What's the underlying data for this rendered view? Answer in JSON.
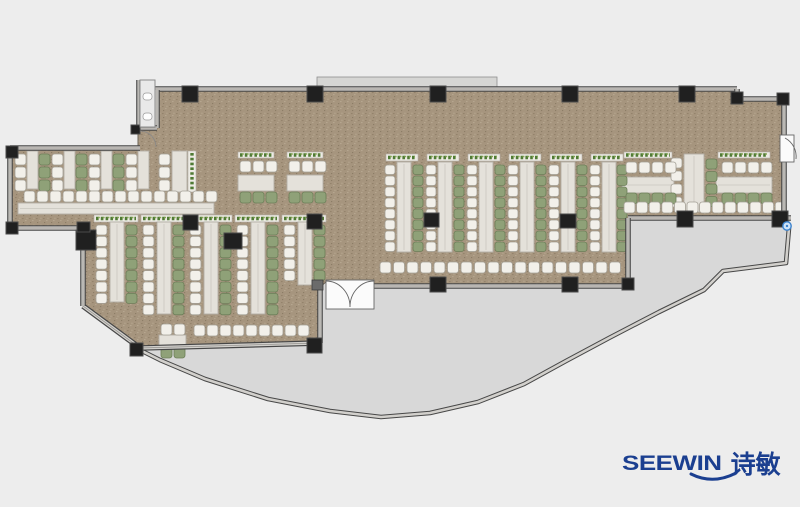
{
  "canvas": {
    "width": 800,
    "height": 507,
    "background": "#ededed"
  },
  "colors": {
    "floor_base": "#a6957e",
    "floor_speck_dark": "#94836c",
    "floor_speck_darker": "#8c7d66",
    "floor_speck_light": "#b5a68f",
    "terrace": "#d8d8d8",
    "terrace_edge": "#9a9a9a",
    "wall_dark": "#474747",
    "wall_fill": "#d2d0cc",
    "wall_center": "#8f8d89",
    "column": "#202020",
    "column_edge": "#4a4a4a",
    "table_fill": "#e4e1da",
    "table_edge": "#b2afa6",
    "chair_white_fill": "#f2f0ea",
    "chair_white_edge": "#a39f95",
    "chair_green_fill": "#8fa178",
    "chair_green_edge": "#6c7e58",
    "planter_fill": "#edebe4",
    "planter_edge": "#b3b0a8",
    "planter_green_dark": "#4f7a34",
    "planter_green_light": "#84a452",
    "door_fill": "#fbfbfb",
    "door_edge": "#666666",
    "ledge_fill": "#d6d6d4",
    "ledge_edge": "#8e8e8e",
    "handle_fill": "#cfe3f7",
    "handle_edge": "#3c82cc",
    "logo_color": "#1b3f90"
  },
  "logo": {
    "brand": "SEEWIN",
    "cn": "诗敏",
    "x": 622,
    "y": 452
  },
  "plan": {
    "building": [
      [
        157,
        90
      ],
      [
        737,
        90
      ],
      [
        737,
        100
      ],
      [
        784,
        100
      ],
      [
        784,
        218
      ],
      [
        628,
        218
      ],
      [
        628,
        286
      ],
      [
        374,
        286
      ],
      [
        374,
        282
      ],
      [
        326,
        282
      ],
      [
        320,
        287
      ],
      [
        320,
        343
      ],
      [
        140,
        348
      ],
      [
        83,
        306
      ],
      [
        83,
        228
      ],
      [
        10,
        228
      ],
      [
        10,
        148
      ],
      [
        138,
        148
      ],
      [
        138,
        128
      ],
      [
        157,
        128
      ]
    ],
    "terrace": [
      [
        140,
        350
      ],
      [
        318,
        344
      ],
      [
        318,
        288
      ],
      [
        326,
        282
      ],
      [
        374,
        282
      ],
      [
        374,
        288
      ],
      [
        628,
        288
      ],
      [
        628,
        220
      ],
      [
        789,
        220
      ],
      [
        789,
        228
      ],
      [
        786,
        263
      ],
      [
        723,
        271
      ],
      [
        704,
        290
      ],
      [
        659,
        312
      ],
      [
        609,
        338
      ],
      [
        566,
        361
      ],
      [
        524,
        384
      ],
      [
        478,
        402
      ],
      [
        430,
        413
      ],
      [
        381,
        417
      ],
      [
        330,
        411
      ],
      [
        268,
        399
      ],
      [
        205,
        379
      ],
      [
        160,
        360
      ]
    ],
    "curve_wall": [
      [
        140,
        350
      ],
      [
        160,
        360
      ],
      [
        205,
        379
      ],
      [
        268,
        399
      ],
      [
        330,
        411
      ],
      [
        381,
        417
      ],
      [
        430,
        413
      ],
      [
        478,
        402
      ],
      [
        524,
        384
      ],
      [
        566,
        361
      ],
      [
        609,
        338
      ],
      [
        659,
        312
      ],
      [
        704,
        290
      ],
      [
        723,
        271
      ],
      [
        786,
        263
      ],
      [
        789,
        228
      ]
    ],
    "ledge": [
      317,
      77,
      180,
      13
    ],
    "walls": [
      [
        152,
        89,
        737,
        89
      ],
      [
        737,
        89,
        737,
        99
      ],
      [
        737,
        99,
        784,
        99
      ],
      [
        784,
        99,
        784,
        136
      ],
      [
        784,
        162,
        784,
        218
      ],
      [
        628,
        218,
        791,
        218
      ],
      [
        628,
        218,
        628,
        286
      ],
      [
        374,
        286,
        628,
        286
      ],
      [
        320,
        287,
        320,
        343
      ],
      [
        140,
        348,
        320,
        343
      ],
      [
        83,
        306,
        140,
        348
      ],
      [
        83,
        228,
        83,
        306
      ],
      [
        10,
        228,
        83,
        228
      ],
      [
        10,
        150,
        10,
        228
      ],
      [
        10,
        148,
        140,
        148
      ],
      [
        157,
        90,
        157,
        128
      ],
      [
        132,
        128,
        157,
        128
      ],
      [
        139,
        80,
        139,
        126
      ]
    ],
    "columns": [
      [
        182,
        86,
        16,
        16
      ],
      [
        307,
        86,
        16,
        16
      ],
      [
        430,
        86,
        16,
        16
      ],
      [
        562,
        86,
        16,
        16
      ],
      [
        679,
        86,
        16,
        16
      ],
      [
        731,
        92,
        12,
        12
      ],
      [
        777,
        93,
        12,
        12
      ],
      [
        183,
        215,
        15,
        15
      ],
      [
        307,
        214,
        15,
        15
      ],
      [
        424,
        213,
        15,
        14
      ],
      [
        560,
        214,
        16,
        14
      ],
      [
        430,
        277,
        16,
        15
      ],
      [
        562,
        277,
        16,
        15
      ],
      [
        622,
        278,
        12,
        12
      ],
      [
        677,
        211,
        16,
        16
      ],
      [
        772,
        211,
        16,
        16
      ],
      [
        76,
        230,
        20,
        20
      ],
      [
        6,
        146,
        12,
        12
      ],
      [
        6,
        222,
        12,
        12
      ],
      [
        77,
        222,
        13,
        10
      ],
      [
        224,
        233,
        18,
        16
      ],
      [
        130,
        343,
        13,
        13
      ],
      [
        307,
        338,
        15,
        15
      ],
      [
        131,
        125,
        9,
        9
      ]
    ],
    "entrance_node": [
      312,
      280,
      11,
      10
    ],
    "doors": {
      "entrance_rect": [
        326,
        280,
        48,
        29
      ],
      "entrance_leaf1": "M326,281 A24,26 0 0 1 350,307",
      "entrance_leaf2": "M374,281 A24,26 0 0 0 350,307",
      "right_rect": [
        780,
        135,
        14,
        27
      ],
      "right_leaf": "M785,138 A21,21 0 0 1 796,159",
      "notch_leaf": "M140,131 A16,16 0 0 1 156,147"
    },
    "cabinet": {
      "rect": [
        140,
        80,
        15,
        47
      ],
      "knobs": [
        [
          143,
          93,
          9,
          7
        ],
        [
          143,
          113,
          9,
          7
        ]
      ]
    },
    "handle": {
      "cx": 787,
      "cy": 226,
      "r": 4.2
    },
    "furniture": {
      "planters_h": [
        [
          94,
          215,
          44,
          7
        ],
        [
          141,
          215,
          44,
          7
        ],
        [
          188,
          215,
          44,
          7
        ],
        [
          235,
          215,
          44,
          7
        ],
        [
          282,
          215,
          44,
          7
        ],
        [
          238,
          152,
          36,
          6
        ],
        [
          287,
          152,
          36,
          6
        ],
        [
          386,
          154,
          32,
          7
        ],
        [
          427,
          154,
          32,
          7
        ],
        [
          468,
          154,
          32,
          7
        ],
        [
          509,
          154,
          32,
          7
        ],
        [
          550,
          154,
          32,
          7
        ],
        [
          591,
          154,
          32,
          7
        ],
        [
          624,
          152,
          48,
          6
        ],
        [
          718,
          152,
          52,
          6
        ]
      ],
      "planters_v": [
        [
          188,
          151,
          8,
          41
        ]
      ],
      "tables": [
        [
          27,
          151,
          11,
          38
        ],
        [
          64,
          151,
          11,
          38
        ],
        [
          101,
          151,
          11,
          38
        ],
        [
          138,
          151,
          11,
          38
        ],
        [
          172,
          151,
          15,
          41
        ],
        [
          18,
          203,
          196,
          11
        ],
        [
          110,
          222,
          14,
          80
        ],
        [
          157,
          222,
          14,
          92
        ],
        [
          204,
          222,
          14,
          92
        ],
        [
          251,
          222,
          14,
          92
        ],
        [
          298,
          222,
          14,
          63
        ],
        [
          159,
          335,
          27,
          11
        ],
        [
          238,
          175,
          36,
          16
        ],
        [
          287,
          175,
          36,
          16
        ],
        [
          397,
          162,
          14,
          90
        ],
        [
          438,
          162,
          14,
          90
        ],
        [
          479,
          162,
          14,
          90
        ],
        [
          520,
          162,
          14,
          90
        ],
        [
          561,
          162,
          14,
          90
        ],
        [
          602,
          162,
          14,
          90
        ],
        [
          622,
          177,
          52,
          16
        ],
        [
          684,
          154,
          20,
          58
        ],
        [
          716,
          177,
          56,
          16
        ]
      ],
      "chair_cols": [
        [
          15,
          154,
          3,
          13,
          "w",
          [
            11,
            11
          ]
        ],
        [
          39,
          154,
          3,
          13,
          "g",
          [
            11,
            11
          ]
        ],
        [
          52,
          154,
          3,
          13,
          "w",
          [
            11,
            11
          ]
        ],
        [
          76,
          154,
          3,
          13,
          "g",
          [
            11,
            11
          ]
        ],
        [
          89,
          154,
          3,
          13,
          "w",
          [
            11,
            11
          ]
        ],
        [
          113,
          154,
          3,
          13,
          "g",
          [
            11,
            11
          ]
        ],
        [
          126,
          154,
          3,
          13,
          "w",
          [
            11,
            11
          ]
        ],
        [
          159,
          154,
          3,
          13,
          "w",
          [
            11,
            11
          ]
        ],
        [
          96,
          225,
          7,
          11.4,
          "w"
        ],
        [
          126,
          225,
          7,
          11.4,
          "g"
        ],
        [
          143,
          225,
          8,
          11.4,
          "w"
        ],
        [
          173,
          225,
          8,
          11.4,
          "g"
        ],
        [
          190,
          225,
          8,
          11.4,
          "w"
        ],
        [
          220,
          225,
          8,
          11.4,
          "g"
        ],
        [
          237,
          225,
          8,
          11.4,
          "w"
        ],
        [
          267,
          225,
          8,
          11.4,
          "g"
        ],
        [
          284,
          225,
          5,
          11.4,
          "w"
        ],
        [
          314,
          225,
          5,
          11.4,
          "g"
        ],
        [
          385,
          165,
          8,
          11,
          "w",
          [
            10,
            9.5
          ]
        ],
        [
          413,
          165,
          8,
          11,
          "g",
          [
            10,
            9.5
          ]
        ],
        [
          426,
          165,
          8,
          11,
          "w",
          [
            10,
            9.5
          ]
        ],
        [
          454,
          165,
          8,
          11,
          "g",
          [
            10,
            9.5
          ]
        ],
        [
          467,
          165,
          8,
          11,
          "w",
          [
            10,
            9.5
          ]
        ],
        [
          495,
          165,
          8,
          11,
          "g",
          [
            10,
            9.5
          ]
        ],
        [
          508,
          165,
          8,
          11,
          "w",
          [
            10,
            9.5
          ]
        ],
        [
          536,
          165,
          8,
          11,
          "g",
          [
            10,
            9.5
          ]
        ],
        [
          549,
          165,
          8,
          11,
          "w",
          [
            10,
            9.5
          ]
        ],
        [
          577,
          165,
          8,
          11,
          "g",
          [
            10,
            9.5
          ]
        ],
        [
          590,
          165,
          8,
          11,
          "w",
          [
            10,
            9.5
          ]
        ],
        [
          617,
          165,
          8,
          11,
          "g",
          [
            10,
            9.5
          ]
        ],
        [
          671,
          158,
          4,
          13,
          "w"
        ],
        [
          706,
          159,
          4,
          12.5,
          "g"
        ]
      ],
      "chair_rows": [
        [
          24,
          191,
          15,
          13,
          "w"
        ],
        [
          240,
          161,
          3,
          13,
          "w"
        ],
        [
          240,
          192,
          3,
          13,
          "g"
        ],
        [
          289,
          161,
          3,
          13,
          "w"
        ],
        [
          289,
          192,
          3,
          13,
          "g"
        ],
        [
          194,
          325,
          9,
          13,
          "w"
        ],
        [
          161,
          324,
          2,
          13,
          "w"
        ],
        [
          161,
          347,
          2,
          13,
          "g"
        ],
        [
          380,
          262,
          18,
          13.5,
          "w"
        ],
        [
          626,
          162,
          4,
          13,
          "w"
        ],
        [
          626,
          193,
          4,
          13,
          "g"
        ],
        [
          722,
          162,
          4,
          13,
          "w"
        ],
        [
          722,
          193,
          4,
          13,
          "g"
        ],
        [
          624,
          202,
          13,
          12.6,
          "w"
        ]
      ]
    }
  }
}
